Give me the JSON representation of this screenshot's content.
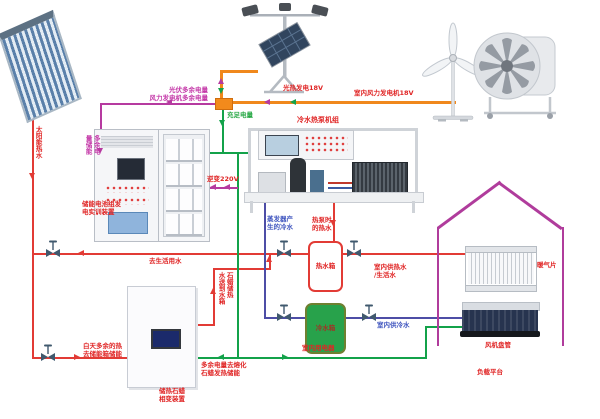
{
  "title": "太阳能/风能多能互补冷热电联供实训系统示意图",
  "colors": {
    "hot_water_line": "#e23b35",
    "cold_water_line": "#4d4da6",
    "power_ok_line": "#13a24a",
    "excess_power_line": "#b63aa0",
    "power_bus_line": "#f0881c",
    "house_outline": "#b03c9c",
    "junction_box": "#f28a1c",
    "cold_tank_fill": "#28a24b"
  },
  "labels": {
    "solar_pipe": "太阳能热水",
    "excess_to_grid": "光伏多余电量\n风力发电机多余电量",
    "pv_gen": "光热发电18V",
    "wind_gen": "室内风力发电机18V",
    "sufficient": "充足电量",
    "store_col_r": "多余电",
    "store_col_l": "量储能",
    "battery_name": "储能电池组发\n电实训装置",
    "inverter": "逆变220V",
    "hp_title": "冷水热泵机组",
    "evap_cold": "蒸发器产\n生的冷水",
    "hp_hot": "热泵时\n的热水",
    "to_domestic": "去生活用水",
    "hot_tank": "热水箱",
    "cold_tank": "冷水箱",
    "indoor_hot": "室内供热水\n/生活水",
    "indoor_cold": "室内供冷水",
    "paraffin_col_r": "石蜡储热",
    "paraffin_col_l": "水送到水箱",
    "day_excess": "白天多余的热\n去储能箱储能",
    "melt": "多余电量去熔化\n石蜡发热储能",
    "paraffin_name": "储热石蜡\n相变装置",
    "appliance": "室内用电器",
    "radiator": "暖气片",
    "fan_coil": "风机盘管",
    "platform": "负载平台"
  }
}
